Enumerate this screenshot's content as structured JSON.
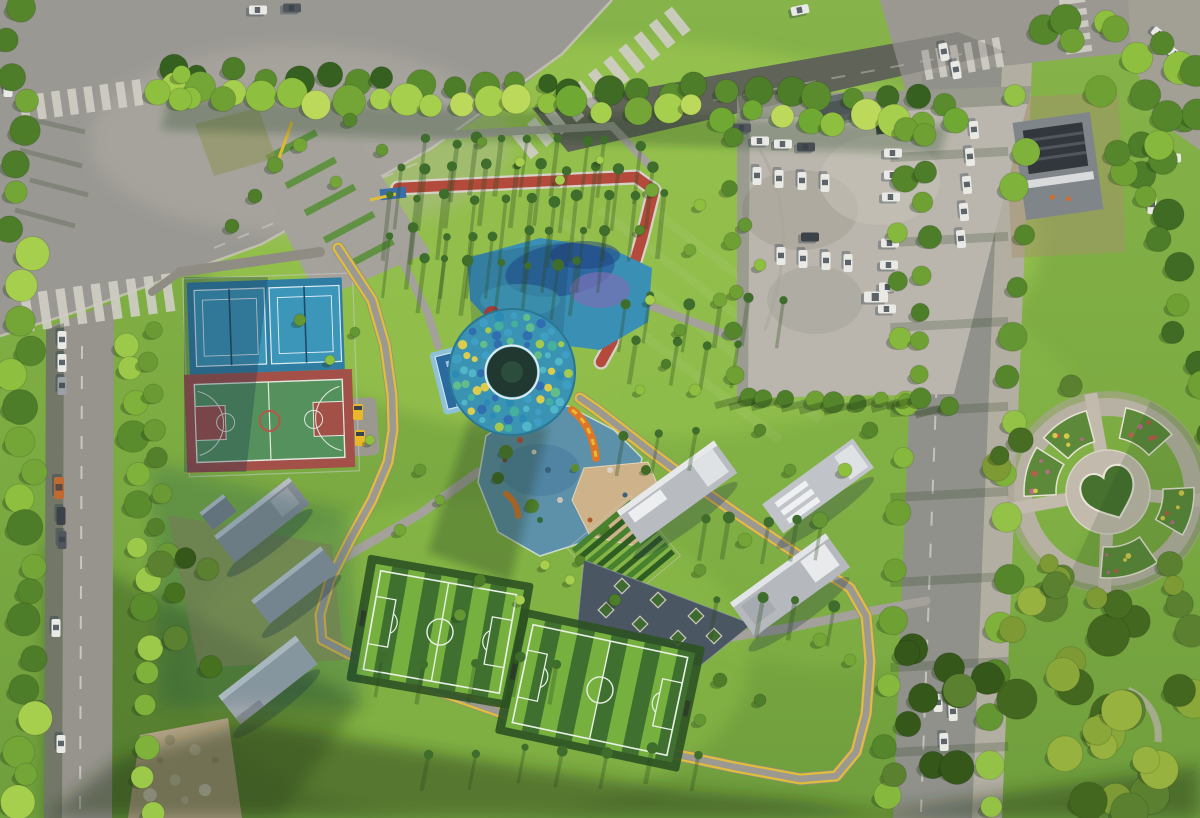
{
  "meta": {
    "type": "aerial-photograph",
    "subject": "urban sports park from above",
    "width": 1200,
    "height": 818
  },
  "palette": {
    "grass": "#7cab42",
    "grass_light": "#a8d055",
    "grass_mid": "#93c24c",
    "grass_dark": "#3e5f26",
    "road": "#98968e",
    "road_dark": "#6e7164",
    "sidewalk": "#b3aea2",
    "lot": "#bab6ad",
    "path_gray": "#a3a19a",
    "path_yellow": "#e2bd3a",
    "track_red": "#b44a3c",
    "track_edge": "#d6d2c8",
    "tennis_outer": "#2f7da2",
    "tennis_court": "#3c96ba",
    "bball_red": "#a35049",
    "bball_green": "#55915d",
    "field_light": "#76b13f",
    "field_dark": "#3f7030",
    "rubber_blue": "#5d90a9",
    "sand": "#cdb28a",
    "plaza_blue": "#3a8fb5",
    "dome_base": "#3a93b2",
    "shadow": "#1e3a18",
    "car_white": "#e9e9e5",
    "car_dark": "#464c52",
    "cart_yellow": "#e8b82a",
    "tree_greens": [
      "#74a637",
      "#8fbf3e",
      "#55862c",
      "#a6cf4d",
      "#4e7d2a",
      "#649634"
    ],
    "dome_dots": [
      "#2f6cb0",
      "#3f9ec4",
      "#52b7c9",
      "#63c08a",
      "#a9cc49",
      "#e3cf4a",
      "#2a8ab5",
      "#45b19c"
    ]
  },
  "counts": {
    "tennis_courts": 2,
    "basketball_courts": 1,
    "soccer_fields": 2,
    "playgrounds": 1,
    "parking_cars": 21
  },
  "tree_bands": [
    {
      "name": "top-treeline-back",
      "x0": 170,
      "y0": 70,
      "x1": 946,
      "y1": 102,
      "n": 26,
      "rmin": 9,
      "rmax": 15,
      "jx": 6,
      "jy": 7,
      "colors": [
        "#3f6b24",
        "#4e7d2a",
        "#35601f",
        "#5a8c2e"
      ]
    },
    {
      "name": "top-treeline-front",
      "x0": 176,
      "y0": 92,
      "x1": 950,
      "y1": 121,
      "n": 28,
      "rmin": 10,
      "rmax": 17,
      "jx": 6,
      "jy": 8,
      "colors": [
        "#8fbf3e",
        "#a6cf4d",
        "#6fa833",
        "#bcd95c",
        "#74a637"
      ]
    },
    {
      "name": "left-road-west",
      "x0": 16,
      "y0": 12,
      "x1": 30,
      "y1": 808,
      "n": 27,
      "rmin": 11,
      "rmax": 18,
      "jx": 13,
      "jy": 6,
      "colors": [
        "#74a637",
        "#8fbf3e",
        "#4e7d2a",
        "#a6cf4d",
        "#55862c"
      ]
    },
    {
      "name": "left-road-east",
      "x0": 133,
      "y0": 338,
      "x1": 147,
      "y1": 810,
      "n": 15,
      "rmin": 10,
      "rmax": 16,
      "jx": 9,
      "jy": 8,
      "colors": [
        "#7fb23a",
        "#9cc94a",
        "#5a8c2e"
      ]
    },
    {
      "name": "park-west-hedge",
      "x0": 152,
      "y0": 330,
      "x1": 163,
      "y1": 556,
      "n": 8,
      "rmin": 8,
      "rmax": 12,
      "jx": 6,
      "jy": 6,
      "colors": [
        "#54802c",
        "#6b9a34",
        "#46721f"
      ]
    },
    {
      "name": "right-road-west",
      "x0": 908,
      "y0": 122,
      "x1": 886,
      "y1": 798,
      "n": 13,
      "rmin": 9,
      "rmax": 15,
      "jx": 8,
      "jy": 10,
      "colors": [
        "#6fa033",
        "#87b83e",
        "#55862c"
      ]
    },
    {
      "name": "right-road-east",
      "x0": 1021,
      "y0": 98,
      "x1": 995,
      "y1": 810,
      "n": 16,
      "rmin": 10,
      "rmax": 16,
      "jx": 9,
      "jy": 8,
      "colors": [
        "#7fb23a",
        "#659634",
        "#93c246",
        "#55862c"
      ]
    },
    {
      "name": "lot-road-strip",
      "x0": 929,
      "y0": 138,
      "x1": 919,
      "y1": 378,
      "n": 8,
      "rmin": 8,
      "rmax": 12,
      "jx": 6,
      "jy": 6,
      "colors": [
        "#6fa033",
        "#4e7d2a"
      ]
    },
    {
      "name": "lot-west-edge",
      "x0": 733,
      "y0": 145,
      "x1": 733,
      "y1": 380,
      "n": 6,
      "rmin": 6,
      "rmax": 10,
      "jx": 5,
      "jy": 8,
      "colors": [
        "#55862c",
        "#6fa033"
      ]
    },
    {
      "name": "lot-bottom-row",
      "x0": 745,
      "y0": 400,
      "x1": 946,
      "y1": 402,
      "n": 10,
      "rmin": 7,
      "rmax": 11,
      "jx": 5,
      "jy": 5,
      "colors": [
        "#55862c",
        "#6fa033",
        "#4e7d2a"
      ],
      "longShadow": true
    },
    {
      "name": "top-right-corner",
      "x0": 1042,
      "y0": 22,
      "x1": 1194,
      "y1": 62,
      "n": 9,
      "rmin": 11,
      "rmax": 17,
      "jx": 8,
      "jy": 15,
      "colors": [
        "#6fa033",
        "#8fbf3e",
        "#55862c"
      ]
    },
    {
      "name": "right-edge-upper",
      "x0": 1152,
      "y0": 152,
      "x1": 1192,
      "y1": 388,
      "n": 9,
      "rmin": 11,
      "rmax": 17,
      "jx": 16,
      "jy": 8,
      "colors": [
        "#4e7d2a",
        "#6fa033",
        "#3f6b24"
      ]
    }
  ],
  "tree_clusters": [
    {
      "name": "forest-bottom-right",
      "x": 1002,
      "y": 600,
      "w": 196,
      "h": 216,
      "n": 26,
      "rmin": 13,
      "rmax": 22,
      "colors": [
        "#7d9a35",
        "#5a8030",
        "#97b23e",
        "#44671f",
        "#8aa73a"
      ]
    },
    {
      "name": "forest-bottom-mid",
      "x": 878,
      "y": 642,
      "w": 122,
      "h": 174,
      "n": 12,
      "rmin": 12,
      "rmax": 19,
      "colors": [
        "#44671f",
        "#5a8030",
        "#35571a"
      ]
    },
    {
      "name": "plaza-tree-ring",
      "ring": true,
      "cx": 1108,
      "cy": 492,
      "rmin": 94,
      "rmax": 120,
      "n": 13,
      "rmin2": 9,
      "rmax2": 15,
      "colors": [
        "#5a8030",
        "#7d9a35",
        "#466d22"
      ]
    },
    {
      "name": "construction-trees",
      "x": 1058,
      "y": 88,
      "w": 140,
      "h": 124,
      "n": 10,
      "rmin": 10,
      "rmax": 16,
      "colors": [
        "#6fa033",
        "#55862c",
        "#87b83e"
      ]
    },
    {
      "name": "entrance-pocket",
      "x": 152,
      "y": 58,
      "w": 84,
      "h": 64,
      "n": 5,
      "rmin": 9,
      "rmax": 14,
      "colors": [
        "#8fbf3e",
        "#6fa033"
      ]
    },
    {
      "name": "west-clump",
      "x": 148,
      "y": 556,
      "w": 72,
      "h": 120,
      "n": 6,
      "rmin": 9,
      "rmax": 14,
      "colors": [
        "#46721f",
        "#35571a",
        "#5a8030"
      ]
    }
  ],
  "tree_scatter": [
    [
      652,
      190,
      7
    ],
    [
      700,
      205,
      6
    ],
    [
      745,
      225,
      7
    ],
    [
      690,
      250,
      6
    ],
    [
      640,
      230,
      5
    ],
    [
      760,
      265,
      6
    ],
    [
      720,
      300,
      7
    ],
    [
      680,
      330,
      6
    ],
    [
      650,
      300,
      5
    ],
    [
      870,
      430,
      8
    ],
    [
      845,
      470,
      7
    ],
    [
      820,
      520,
      8
    ],
    [
      790,
      470,
      6
    ],
    [
      760,
      430,
      6
    ],
    [
      745,
      540,
      7
    ],
    [
      700,
      570,
      6
    ],
    [
      615,
      600,
      6
    ],
    [
      570,
      580,
      5
    ],
    [
      300,
      320,
      6
    ],
    [
      330,
      360,
      5
    ],
    [
      355,
      332,
      5
    ],
    [
      420,
      470,
      6
    ],
    [
      440,
      500,
      5
    ],
    [
      400,
      530,
      6
    ],
    [
      370,
      440,
      5
    ],
    [
      480,
      580,
      6
    ],
    [
      520,
      600,
      5
    ],
    [
      460,
      615,
      6
    ],
    [
      720,
      680,
      7
    ],
    [
      760,
      700,
      6
    ],
    [
      700,
      720,
      6
    ],
    [
      820,
      640,
      7
    ],
    [
      850,
      660,
      6
    ],
    [
      560,
      180,
      5
    ],
    [
      520,
      162,
      5
    ],
    [
      482,
      142,
      5
    ],
    [
      600,
      160,
      4
    ],
    [
      640,
      390,
      5
    ],
    [
      666,
      364,
      5
    ],
    [
      695,
      390,
      6
    ],
    [
      580,
      560,
      5
    ],
    [
      545,
      565,
      5
    ],
    [
      275,
      165,
      8
    ],
    [
      300,
      145,
      7
    ],
    [
      255,
      196,
      7
    ],
    [
      232,
      226,
      7
    ],
    [
      350,
      120,
      7
    ],
    [
      382,
      150,
      6
    ],
    [
      336,
      182,
      6
    ]
  ],
  "streak_rows": [
    {
      "y": 142,
      "x0": 428,
      "x1": 636,
      "n": 9,
      "len": 58
    },
    {
      "y": 168,
      "x0": 402,
      "x1": 648,
      "n": 10,
      "len": 62
    },
    {
      "y": 198,
      "x0": 392,
      "x1": 662,
      "n": 11,
      "len": 66
    },
    {
      "y": 232,
      "x0": 386,
      "x1": 610,
      "n": 9,
      "len": 62
    },
    {
      "y": 262,
      "x0": 420,
      "x1": 580,
      "n": 7,
      "len": 55
    },
    {
      "y": 300,
      "x0": 620,
      "x1": 780,
      "n": 6,
      "len": 48
    },
    {
      "y": 345,
      "x0": 640,
      "x1": 735,
      "n": 4,
      "len": 44
    },
    {
      "y": 432,
      "x0": 620,
      "x1": 700,
      "n": 3,
      "len": 40
    },
    {
      "y": 520,
      "x0": 700,
      "x1": 828,
      "n": 5,
      "len": 42
    },
    {
      "y": 602,
      "x0": 722,
      "x1": 830,
      "n": 4,
      "len": 40
    },
    {
      "y": 660,
      "x0": 380,
      "x1": 560,
      "n": 5,
      "len": 40
    },
    {
      "y": 752,
      "x0": 430,
      "x1": 700,
      "n": 7,
      "len": 36
    }
  ],
  "cars": {
    "parking": [
      {
        "x": 760,
        "y": 141,
        "a": 0
      },
      {
        "x": 783,
        "y": 144,
        "a": 0
      },
      {
        "x": 806,
        "y": 147,
        "a": 0,
        "c": "#464c52"
      },
      {
        "x": 757,
        "y": 176,
        "a": 90
      },
      {
        "x": 779,
        "y": 179,
        "a": 90
      },
      {
        "x": 802,
        "y": 181,
        "a": 90
      },
      {
        "x": 825,
        "y": 183,
        "a": 90
      },
      {
        "x": 893,
        "y": 153,
        "a": 0
      },
      {
        "x": 893,
        "y": 175,
        "a": 0
      },
      {
        "x": 891,
        "y": 197,
        "a": 0
      },
      {
        "x": 890,
        "y": 243,
        "a": 0
      },
      {
        "x": 889,
        "y": 265,
        "a": 0
      },
      {
        "x": 888,
        "y": 287,
        "a": 0
      },
      {
        "x": 887,
        "y": 309,
        "a": 0
      },
      {
        "x": 781,
        "y": 256,
        "a": 90
      },
      {
        "x": 803,
        "y": 259,
        "a": 90
      },
      {
        "x": 826,
        "y": 261,
        "a": 90
      },
      {
        "x": 848,
        "y": 263,
        "a": 90
      },
      {
        "x": 810,
        "y": 237,
        "a": 0,
        "c": "#3c4248"
      },
      {
        "x": 876,
        "y": 297,
        "a": 0,
        "w": 24,
        "h": 11
      },
      {
        "x": 742,
        "y": 128,
        "a": 0,
        "c": "#50565c"
      }
    ],
    "left_road": [
      {
        "x": 62,
        "y": 340,
        "a": 90
      },
      {
        "x": 62,
        "y": 363,
        "a": 90
      },
      {
        "x": 62,
        "y": 386,
        "a": 90,
        "c": "#9aa0a6"
      },
      {
        "x": 59,
        "y": 488,
        "a": 90,
        "c": "#c06a32",
        "w": 22,
        "h": 10
      },
      {
        "x": 61,
        "y": 516,
        "a": 90,
        "c": "#3c4248"
      },
      {
        "x": 62,
        "y": 540,
        "a": 90,
        "c": "#50565c"
      },
      {
        "x": 56,
        "y": 628,
        "a": 90
      },
      {
        "x": 61,
        "y": 744,
        "a": 90
      },
      {
        "x": 41,
        "y": 712,
        "a": 90,
        "c": "#3c4248"
      }
    ],
    "right_road": [
      {
        "x": 944,
        "y": 52,
        "a": 80
      },
      {
        "x": 956,
        "y": 70,
        "a": 80
      },
      {
        "x": 974,
        "y": 130,
        "a": 85
      },
      {
        "x": 970,
        "y": 157,
        "a": 85
      },
      {
        "x": 967,
        "y": 185,
        "a": 85
      },
      {
        "x": 964,
        "y": 212,
        "a": 85
      },
      {
        "x": 961,
        "y": 239,
        "a": 85
      },
      {
        "x": 938,
        "y": 703,
        "a": 88
      },
      {
        "x": 953,
        "y": 712,
        "a": 88
      },
      {
        "x": 944,
        "y": 742,
        "a": 88
      }
    ],
    "far_right": [
      {
        "x": 1158,
        "y": 138,
        "a": 0
      },
      {
        "x": 1172,
        "y": 158,
        "a": 0
      },
      {
        "x": 1152,
        "y": 205,
        "a": 90
      },
      {
        "x": 1160,
        "y": 35,
        "a": 40
      },
      {
        "x": 1176,
        "y": 55,
        "a": 40
      }
    ],
    "intersection": [
      {
        "x": 258,
        "y": 10,
        "a": 0
      },
      {
        "x": 292,
        "y": 8,
        "a": 0,
        "c": "#50565c"
      },
      {
        "x": 800,
        "y": 10,
        "a": -12
      },
      {
        "x": 8,
        "y": 88,
        "a": 90
      }
    ],
    "carts": [
      [
        358,
        412
      ],
      [
        360,
        438
      ]
    ]
  },
  "crosswalks": [
    {
      "cx": 85,
      "cy": 100,
      "len": 130,
      "h": 26,
      "rot": -8,
      "n": 8
    },
    {
      "cx": 102,
      "cy": 302,
      "len": 160,
      "h": 38,
      "rot": -8,
      "n": 9
    },
    {
      "cx": 605,
      "cy": 80,
      "len": 215,
      "h": 30,
      "rot": -39,
      "n": 11
    },
    {
      "cx": 966,
      "cy": 58,
      "len": 86,
      "h": 30,
      "rot": -10,
      "n": 6
    },
    {
      "cx": 1076,
      "cy": 28,
      "len": 62,
      "h": 26,
      "rot": 82,
      "n": 5
    }
  ],
  "road_shadow_bands": [
    150,
    235,
    320,
    405,
    490,
    575,
    660,
    745
  ],
  "plaza_strips": {
    "x0": 282,
    "y0": 132,
    "x1": 378,
    "y1": 268,
    "n": 5,
    "rot": -28,
    "w": 56,
    "h": 7
  },
  "dome": {
    "cx": 512,
    "cy": 372,
    "r_outer": 63,
    "r_inner": 25,
    "rings": [
      31,
      39.5,
      48,
      56.5
    ],
    "ring_counts": [
      12,
      16,
      20,
      24
    ]
  },
  "fields": [
    {
      "cx": 440,
      "cy": 632,
      "rot": 10,
      "w": 150,
      "h": 112,
      "n": 9
    },
    {
      "cx": 600,
      "cy": 690,
      "rot": 12,
      "w": 170,
      "h": 112,
      "n": 10
    }
  ],
  "circular_plaza": {
    "cx": 1108,
    "cy": 492,
    "wedges": [
      [
        105,
        140,
        52,
        84
      ],
      [
        148,
        183,
        52,
        84
      ],
      [
        42,
        78,
        55,
        86
      ],
      [
        -30,
        3,
        55,
        86
      ],
      [
        -95,
        -55,
        55,
        86
      ]
    ],
    "spokes": [
      100,
      190,
      268,
      355
    ]
  },
  "triangle_planters": [
    [
      622,
      586
    ],
    [
      658,
      600
    ],
    [
      696,
      616
    ],
    [
      640,
      624
    ],
    [
      606,
      610
    ],
    [
      678,
      638
    ],
    [
      714,
      636
    ]
  ],
  "playground_items": [
    [
      520,
      440,
      3,
      "#c94b38"
    ],
    [
      534,
      452,
      2.5,
      "#d8d2c6"
    ],
    [
      548,
      470,
      3,
      "#3a5f7a"
    ],
    [
      505,
      460,
      2.5,
      "#6b4e2e"
    ],
    [
      560,
      500,
      3,
      "#c9c4b8"
    ],
    [
      590,
      520,
      2.5,
      "#b05a2a"
    ],
    [
      610,
      470,
      3,
      "#d8d2c6"
    ],
    [
      625,
      495,
      2.5,
      "#3a5f7a"
    ],
    [
      540,
      520,
      3,
      "#2f6b3a"
    ]
  ],
  "bushes": [
    [
      506,
      452,
      7
    ],
    [
      498,
      478,
      6
    ],
    [
      532,
      506,
      7
    ],
    [
      604,
      530,
      6
    ],
    [
      646,
      470,
      5
    ],
    [
      575,
      468,
      4
    ]
  ],
  "pool_cells": {
    "cols": [
      450,
      472
    ],
    "rows": [
      356,
      366,
      376,
      386,
      396
    ],
    "w": 15,
    "h": 6
  },
  "rubble_speckles": [
    [
      160,
      760
    ],
    [
      175,
      780
    ],
    [
      195,
      750
    ],
    [
      205,
      790
    ],
    [
      185,
      800
    ],
    [
      150,
      795
    ],
    [
      215,
      760
    ],
    [
      170,
      740
    ]
  ],
  "mow_lines": [
    [
      560,
      220,
      820,
      420
    ],
    [
      600,
      210,
      860,
      410
    ],
    [
      520,
      240,
      780,
      440
    ],
    [
      640,
      200,
      900,
      400
    ]
  ]
}
